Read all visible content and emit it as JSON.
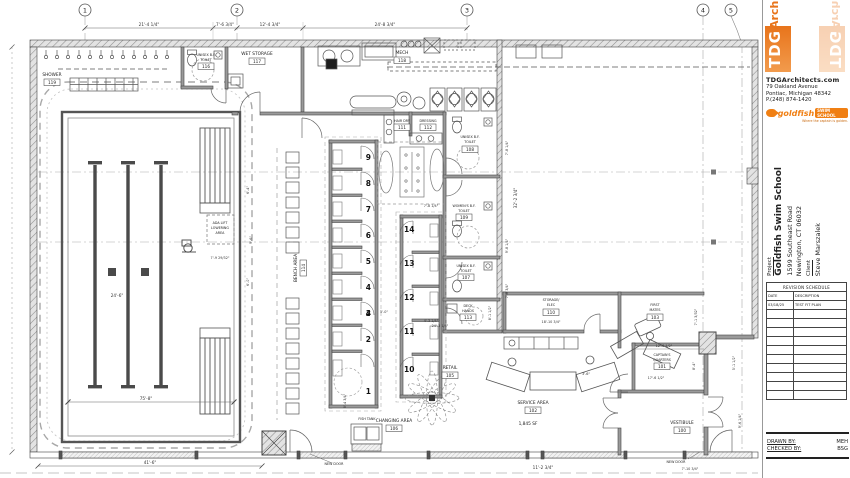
{
  "plan": {
    "grid": [
      "1",
      "2",
      "3",
      "4",
      "5"
    ],
    "rooms": [
      {
        "n1": "SHOWER",
        "num": "119"
      },
      {
        "n1": "UNISEX B.F.",
        "n2": "TOILET",
        "num": "116"
      },
      {
        "n1": "WET STORAGE",
        "num": "117"
      },
      {
        "n1": "MECH",
        "num": "118"
      },
      {
        "n1": "HAIR DRY",
        "num": "111"
      },
      {
        "n1": "DRESSING",
        "num": "112"
      },
      {
        "n1": "UNISEX B.F.",
        "n2": "TOILET",
        "num": "108"
      },
      {
        "n1": "WOMEN'S B.F.",
        "n2": "TOILET",
        "num": "109"
      },
      {
        "n1": "UNISEX B.F.",
        "n2": "TOILET",
        "num": "107"
      },
      {
        "n1": "DECK",
        "n2": "HANDS",
        "num": "113"
      },
      {
        "n1": "BENCH AREA",
        "num": "114"
      },
      {
        "n1": "CHANGING AREA",
        "num": "106"
      },
      {
        "n1": "RETAIL",
        "num": "105"
      },
      {
        "n1": "SERVICE AREA",
        "num": "102"
      },
      {
        "n1": "STORAGE/",
        "n2": "ELEC",
        "num": "110"
      },
      {
        "n1": "FIRST",
        "n2": "MATES",
        "num": "103"
      },
      {
        "n1": "CAPTAIN'S",
        "n2": "QUARTERS",
        "num": "101"
      },
      {
        "n1": "VESTIBULE",
        "num": "100"
      }
    ],
    "stalls_left": [
      "9",
      "8",
      "7",
      "6",
      "5",
      "4",
      "3",
      "2",
      "1"
    ],
    "stalls_right": [
      "14",
      "13",
      "12",
      "11",
      "10"
    ],
    "dims": [
      "21'-4 1/4\"",
      "7'-6 3/4\"",
      "12'-4 3/4\"",
      "24'-8 3/4\"",
      "24'-6\"",
      "75'-8\"",
      "41'-6\"",
      "7'-9 29/32\"",
      "7'-8 1/4\"",
      "5'-0\"",
      "4'-3 1/4\"",
      "8'-4 3/4\"",
      "7'-8 1/4\"",
      "32'-2 3/4\"",
      "9'-8 1/4\"",
      "7'-8 3/4\"",
      "18'-10 3/4\"",
      "12'-6 1/2\"",
      "17'-6 1/2\"",
      "8'-4\"",
      "7'-1 3/32\"",
      "3'-6\"",
      "5'-1 1/2\"",
      "9'-6 1/4\"",
      "11'-2 3/4\"",
      "7'-10 3/4\"",
      "8'-1 1/2\"",
      "24'-3 1/4\"",
      "6'-4\"",
      "9'-6\"",
      "6'-0\""
    ],
    "notes": {
      "ada1": "ADA LIFT",
      "ada2": "LOWERING",
      "ada3": "AREA",
      "fish_tank": "FISH TANK",
      "new_door": "NEW DOOR",
      "service_sf": "1,845 SF"
    }
  },
  "title_block": {
    "firm": {
      "logo_vertical": "TDG",
      "logo_horizontal": "Archi",
      "website": "TDGArchitects.com",
      "address1": "79 Oakland Avenue",
      "address2": "Pontiac, Michigan 48342",
      "phone": "P.(248) 874-1420"
    },
    "brand": {
      "name": "goldfish",
      "sub": "SWIM SCHOOL",
      "tagline": "Where the captain is golden."
    },
    "project": {
      "label": "Project",
      "name": "Goldfish Swim School",
      "address1": "1599 Southeast Road",
      "address2": "Newington, CT 06032",
      "client_label": "Client",
      "client": "Steve Marszalek"
    },
    "revision": {
      "title": "REVISION SCHEDULE",
      "col_date": "DATE",
      "col_desc": "DESCRIPTION",
      "rows": [
        {
          "date": "03/18/25",
          "desc": "TEST FIT PLAN"
        }
      ],
      "empty_rows": 10
    },
    "signoff": {
      "drawn_label": "DRAWN BY:",
      "drawn": "MEH",
      "checked_label": "CHECKED BY:",
      "checked": "BSG"
    }
  }
}
